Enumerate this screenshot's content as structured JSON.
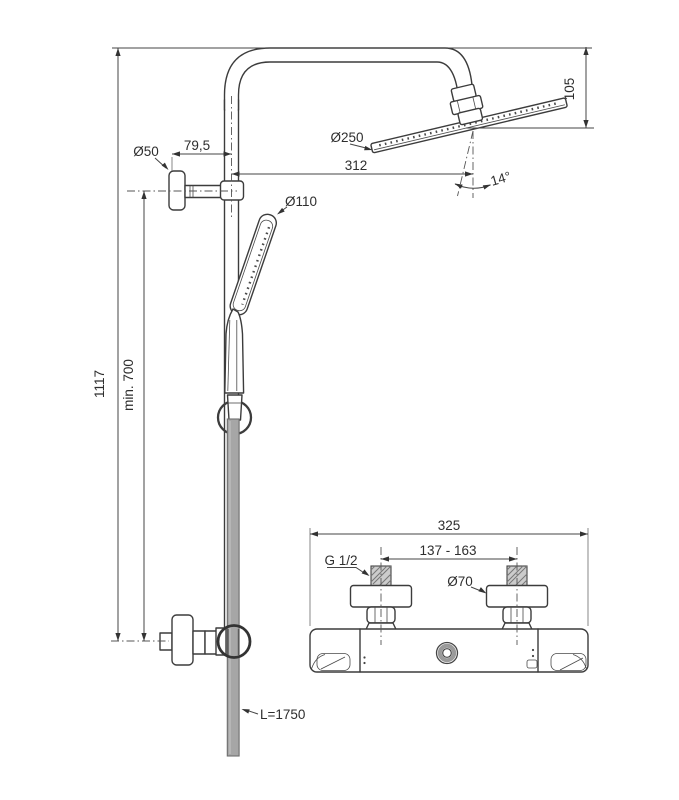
{
  "column": {
    "total_height": "1117",
    "min_mount_height": "min. 700",
    "bracket_offset": "79,5",
    "bracket_diameter": "Ø50",
    "handshower_diameter": "Ø110",
    "rainhead_diameter": "Ø250",
    "head_drop": "105",
    "head_reach": "312",
    "head_tilt": "14°",
    "hose_length": "L=1750"
  },
  "mixer": {
    "body_width": "325",
    "inlet_spacing": "137 - 163",
    "connection_thread": "G 1/2",
    "escutcheon_diameter": "Ø70"
  },
  "colors": {
    "line": "#3c3c3c",
    "dimension": "#454545",
    "hose": "#a6a6a6",
    "background": "#ffffff"
  }
}
